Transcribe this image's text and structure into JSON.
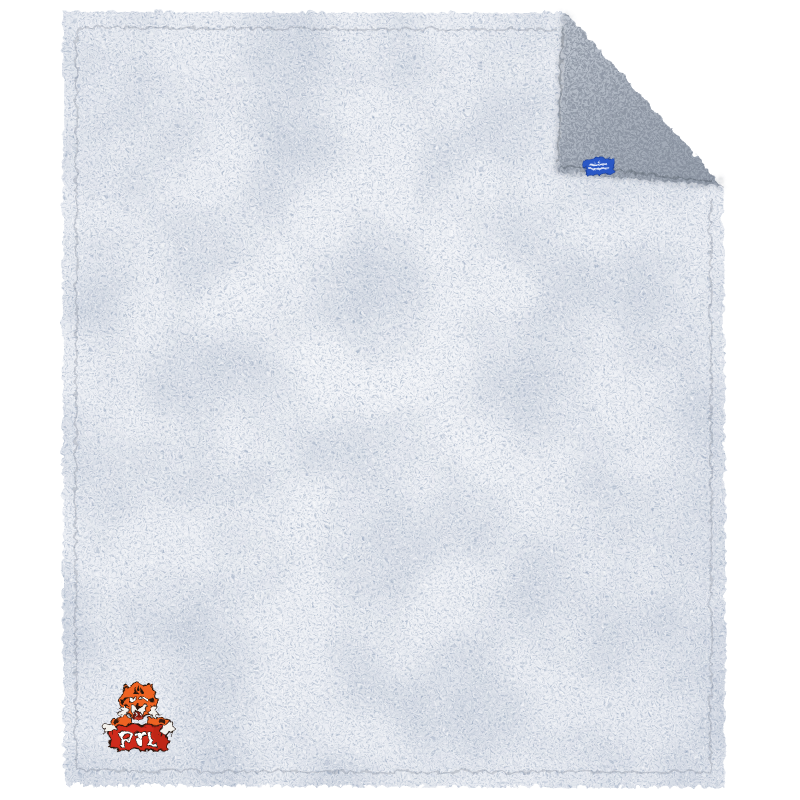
{
  "scene": {
    "description": "Product photo of a frosted sherpa fleece blanket with the top-right corner folded over to show the darker reverse pile, shot on a plain white background",
    "background_color": "#ffffff"
  },
  "blanket": {
    "front_base_color": "#edf0f5",
    "front_fleck_color": "#8795ab",
    "reverse_base_color": "#aab2be",
    "reverse_fleck_color": "#49525f",
    "hem_stitch_color": "#4d5668",
    "fold": {
      "location": "top-right corner",
      "side_shown": "reverse sherpa pile"
    }
  },
  "brand_tag": {
    "fill_color": "#2b58c6",
    "border_color": "#1e3f96",
    "text_color": "#e9eef9",
    "text_lines": 2,
    "legible": false
  },
  "logo": {
    "text": "PTL",
    "mascot": "tiger",
    "orange": "#ee6322",
    "red": "#cf2b1a",
    "dark_red": "#a81f12",
    "letter_fill": "#ffffff",
    "outline": "#241610",
    "white_fur": "#f3f1ec",
    "mouth": "#7d130b"
  }
}
